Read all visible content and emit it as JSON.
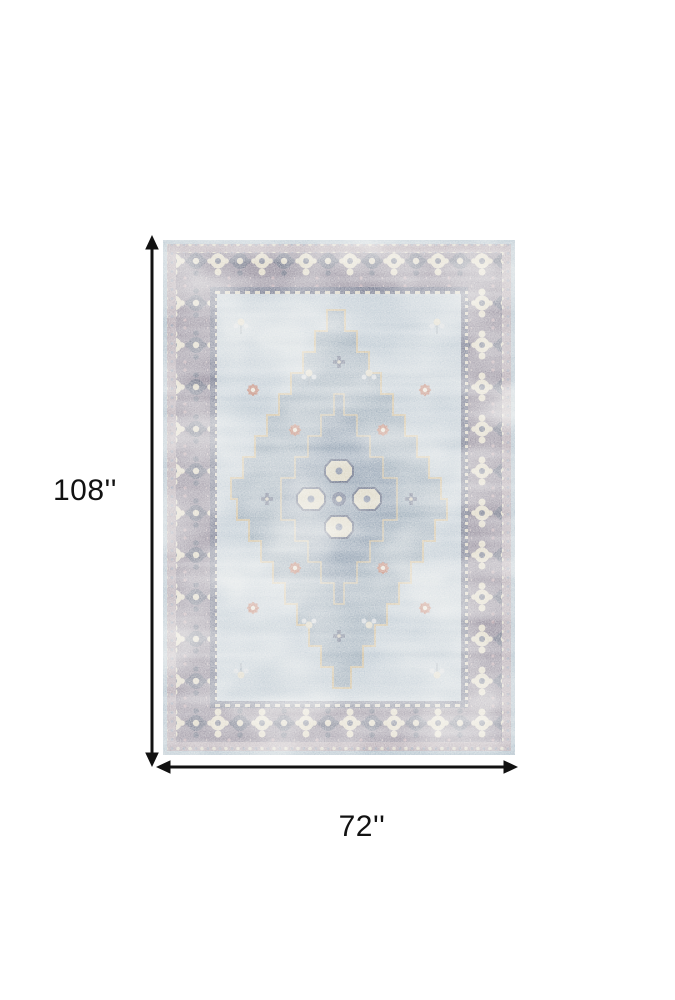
{
  "page": {
    "background": "#ffffff"
  },
  "product_diagram": {
    "height_label": "108''",
    "width_label": "72''",
    "annotation_color": "#111111",
    "label_color": "#121212"
  },
  "rug": {
    "description": "Distressed vintage medallion area rug in light blue, grey, mauve and ivory",
    "palette": {
      "outer_edge": "#a9bbc8",
      "outer_band": "#a89ba5",
      "border_base": "#867e8f",
      "border_motif_ivory": "#dcd5c2",
      "border_motif_dark": "#5e6378",
      "guard_base": "#636880",
      "field": "#b8c5d0",
      "medallion": "#94a5b4",
      "medallion_inner": "#8798ab",
      "medallion_outline": "#c9b795",
      "center_cream": "#d7d1bd",
      "center_dark": "#4f5974",
      "accent_rust": "#b5705d"
    }
  }
}
